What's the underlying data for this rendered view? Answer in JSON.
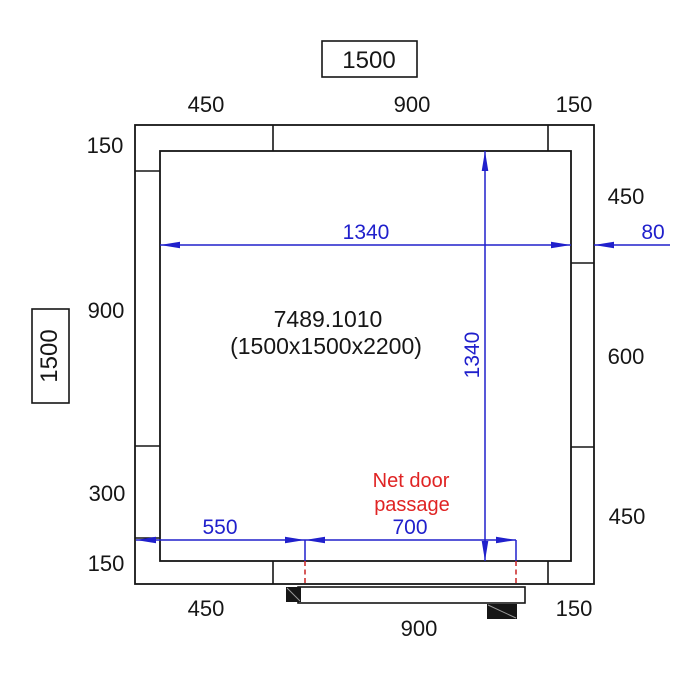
{
  "product": {
    "article": "7489.1010",
    "size": "(1500x1500x2200)"
  },
  "overall": {
    "width_boxed": "1500",
    "depth_boxed": "1500"
  },
  "panel_dims": {
    "top": [
      "450",
      "900",
      "150"
    ],
    "left": [
      "150",
      "900",
      "300",
      "150"
    ],
    "right": [
      "450",
      "600",
      "450"
    ],
    "bottom": [
      "450",
      "900",
      "150"
    ]
  },
  "interior": {
    "width": "1340",
    "depth": "1340"
  },
  "wall": {
    "thickness": "80"
  },
  "door": {
    "offset_from_wall": "550",
    "net_passage": "700",
    "note_line1": "Net door",
    "note_line2": "passage"
  },
  "colors": {
    "line": "#161616",
    "blue": "#2020cc",
    "red_text": "#e02424",
    "red_dash": "#cc3030",
    "bg": "#ffffff"
  }
}
